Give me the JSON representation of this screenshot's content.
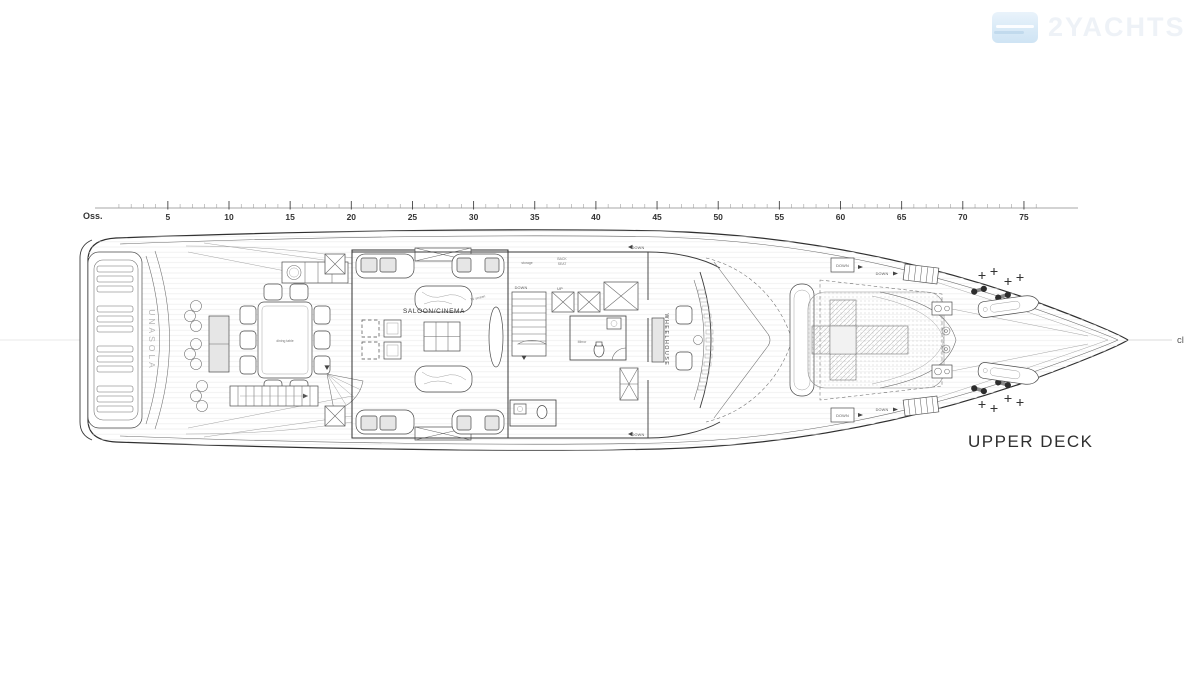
{
  "logo": {
    "text": "2YACHTS"
  },
  "ruler": {
    "origin_label": "Oss.",
    "tick_labels": [
      5,
      10,
      15,
      20,
      25,
      30,
      35,
      40,
      45,
      50,
      55,
      60,
      65,
      70,
      75
    ],
    "units_per_major": 5
  },
  "plan": {
    "deck_title": "UPPER DECK",
    "centerline_label": "cl",
    "yacht_name": "UNASOLA",
    "labels": {
      "saloon": "SALOON/CINEMA",
      "wheelhouse": "WHEELHOUSE",
      "dining_table": "dining table",
      "storage": "storage",
      "back_seat_1": "BACK",
      "back_seat_2": "SEAT",
      "mirror": "Mirror",
      "tv": "TV screen",
      "up": "UP",
      "down": "DOWN"
    }
  },
  "colors": {
    "line": "#3a3a3a",
    "light_fill": "#e6e6e6",
    "logo_blue": "#d9eaf7",
    "name_gray": "#b5b5b5"
  }
}
